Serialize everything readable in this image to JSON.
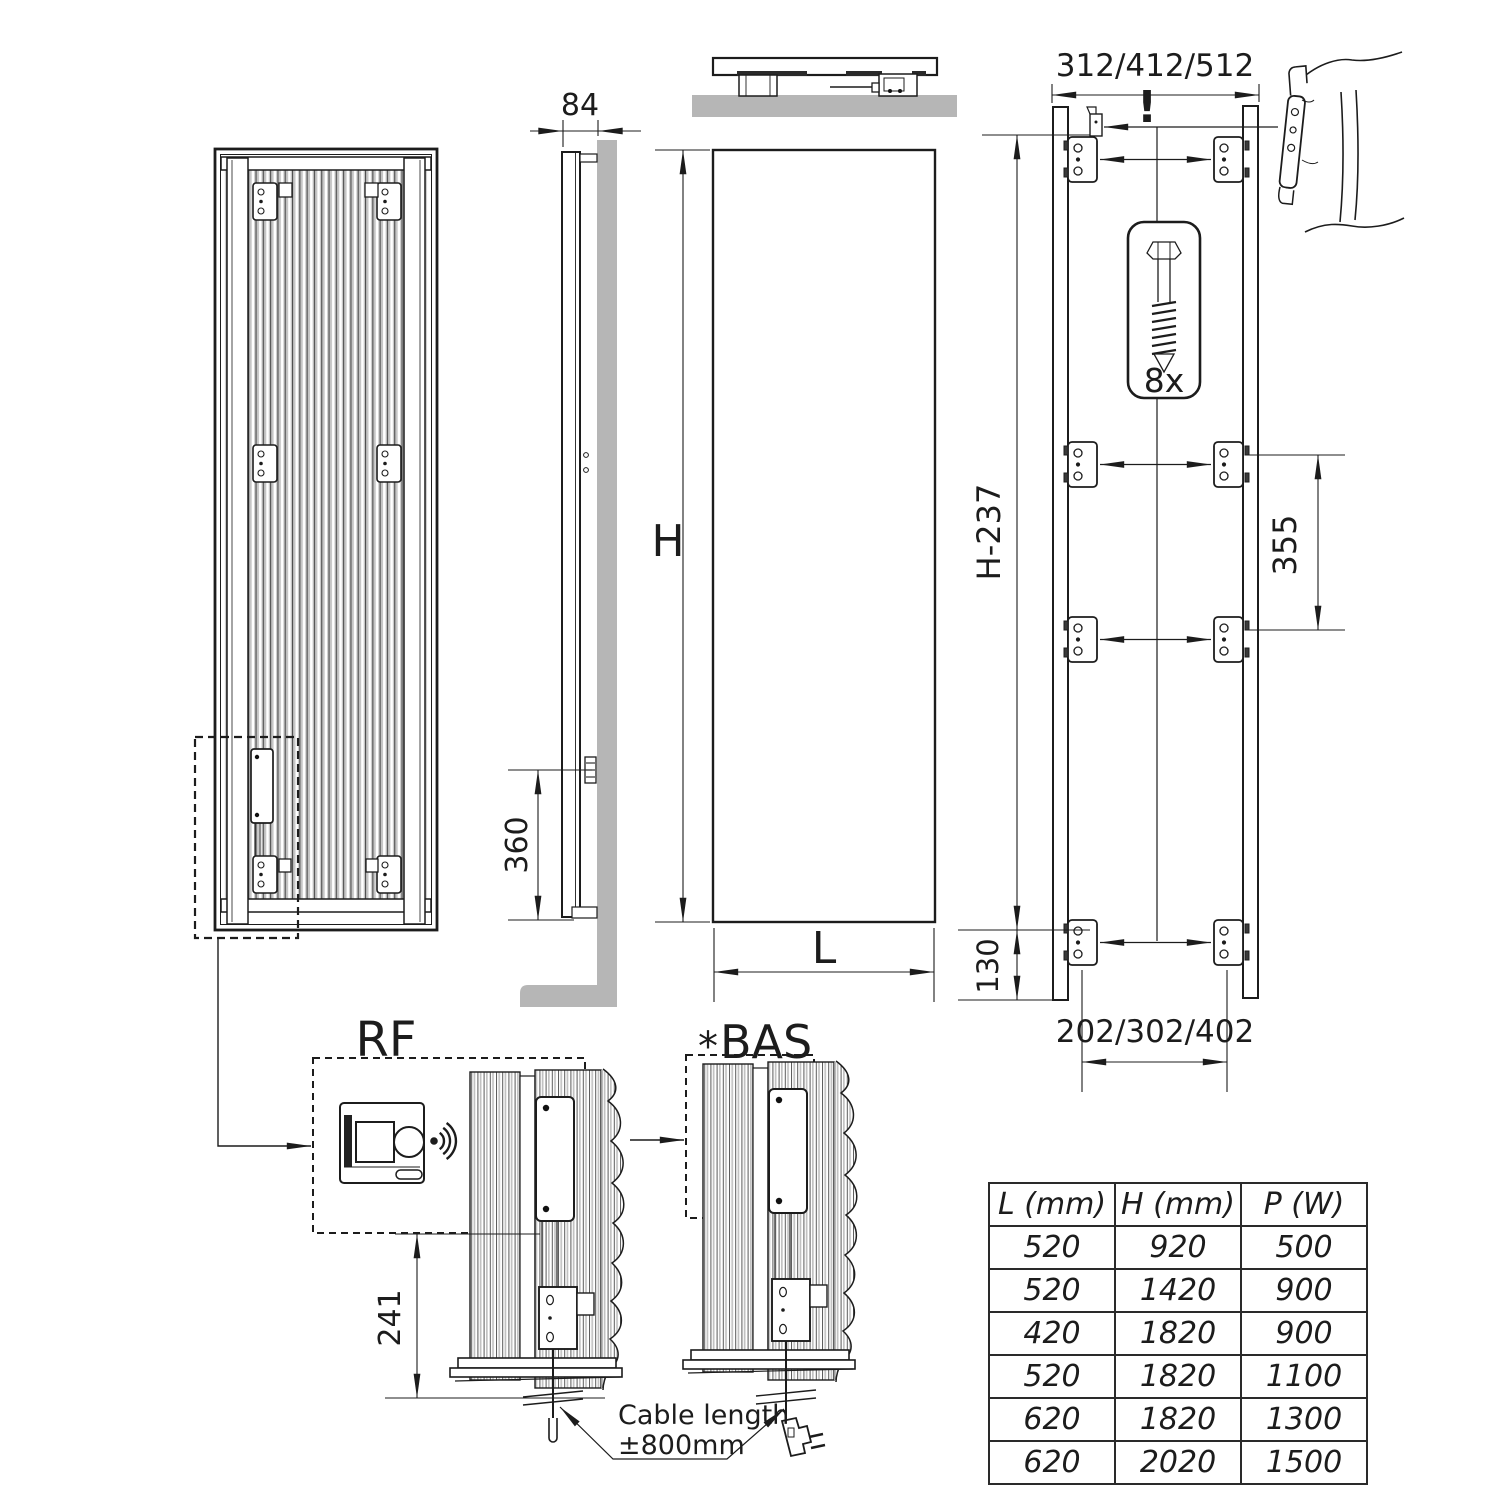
{
  "labels": {
    "side_depth": "84",
    "side_bottom_height": "360",
    "front_height": "H",
    "front_width": "L",
    "rear_width_options": "312/412/512",
    "warning": "!",
    "screw_count": "8x",
    "rear_bracket_height": "H-237",
    "bracket_vertical_gap": "355",
    "bottom_offset": "130",
    "bracket_width_options": "202/302/402",
    "rf_label": "RF",
    "bas_star": "*",
    "bas_label": "BAS",
    "rf_unit_height": "241",
    "cable_note_line1": "Cable length",
    "cable_note_line2": "±800mm"
  },
  "table": {
    "headers": [
      "L (mm)",
      "H (mm)",
      "P (W)"
    ],
    "rows": [
      [
        "520",
        "920",
        "500"
      ],
      [
        "520",
        "1420",
        "900"
      ],
      [
        "420",
        "1820",
        "900"
      ],
      [
        "520",
        "1820",
        "1100"
      ],
      [
        "620",
        "1820",
        "1300"
      ],
      [
        "620",
        "2020",
        "1500"
      ]
    ]
  },
  "colors": {
    "line": "#1c1c1c",
    "wall_gray": "#b6b6b6",
    "tube_gray": "#c6c6c6",
    "dark_detail": "#3a3a3a"
  }
}
